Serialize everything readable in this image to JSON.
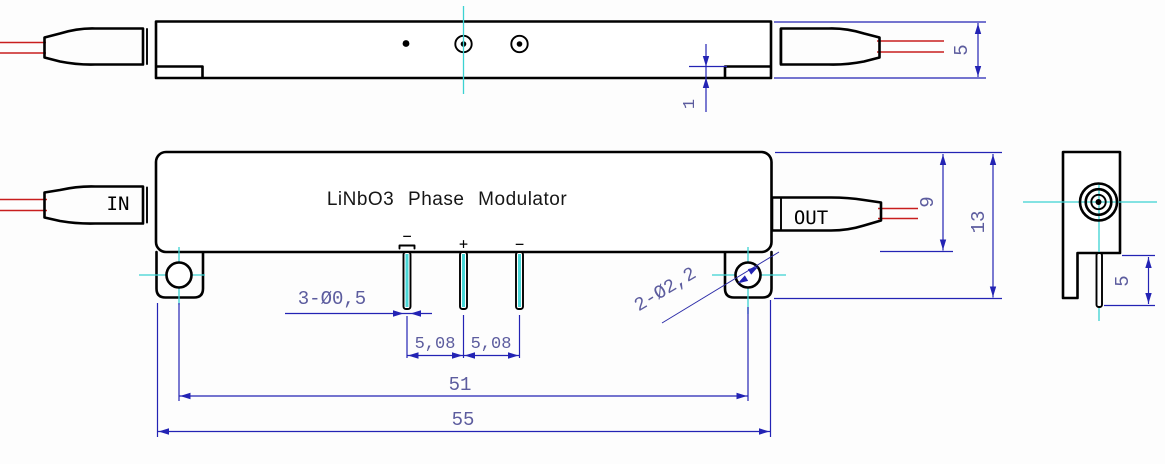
{
  "drawing": {
    "title": "LiNbO3 Phase Modulator",
    "front_view": {
      "input_label": "IN",
      "output_label": "OUT",
      "pin_labels": [
        "−",
        "+",
        "−"
      ],
      "dim_pin_diameter": "3-Ø0,5",
      "dim_pin_pitch_1": "5,08",
      "dim_pin_pitch_2": "5,08",
      "dim_mount_hole_spacing": "51",
      "dim_total_length": "55",
      "dim_body_height": "9",
      "dim_total_height": "13",
      "dim_mount_hole_diameter": "2-Ø2,2"
    },
    "top_view": {
      "dim_flange_step": "1",
      "dim_body_thickness": "5"
    },
    "side_view": {
      "dim_pin_length": "5"
    },
    "colors": {
      "outline": "#000000",
      "fiber": "#c81e1e",
      "centerline": "#3bd2d2",
      "dimension_line": "#2323b4",
      "dimension_text": "#5c5c9e"
    }
  }
}
